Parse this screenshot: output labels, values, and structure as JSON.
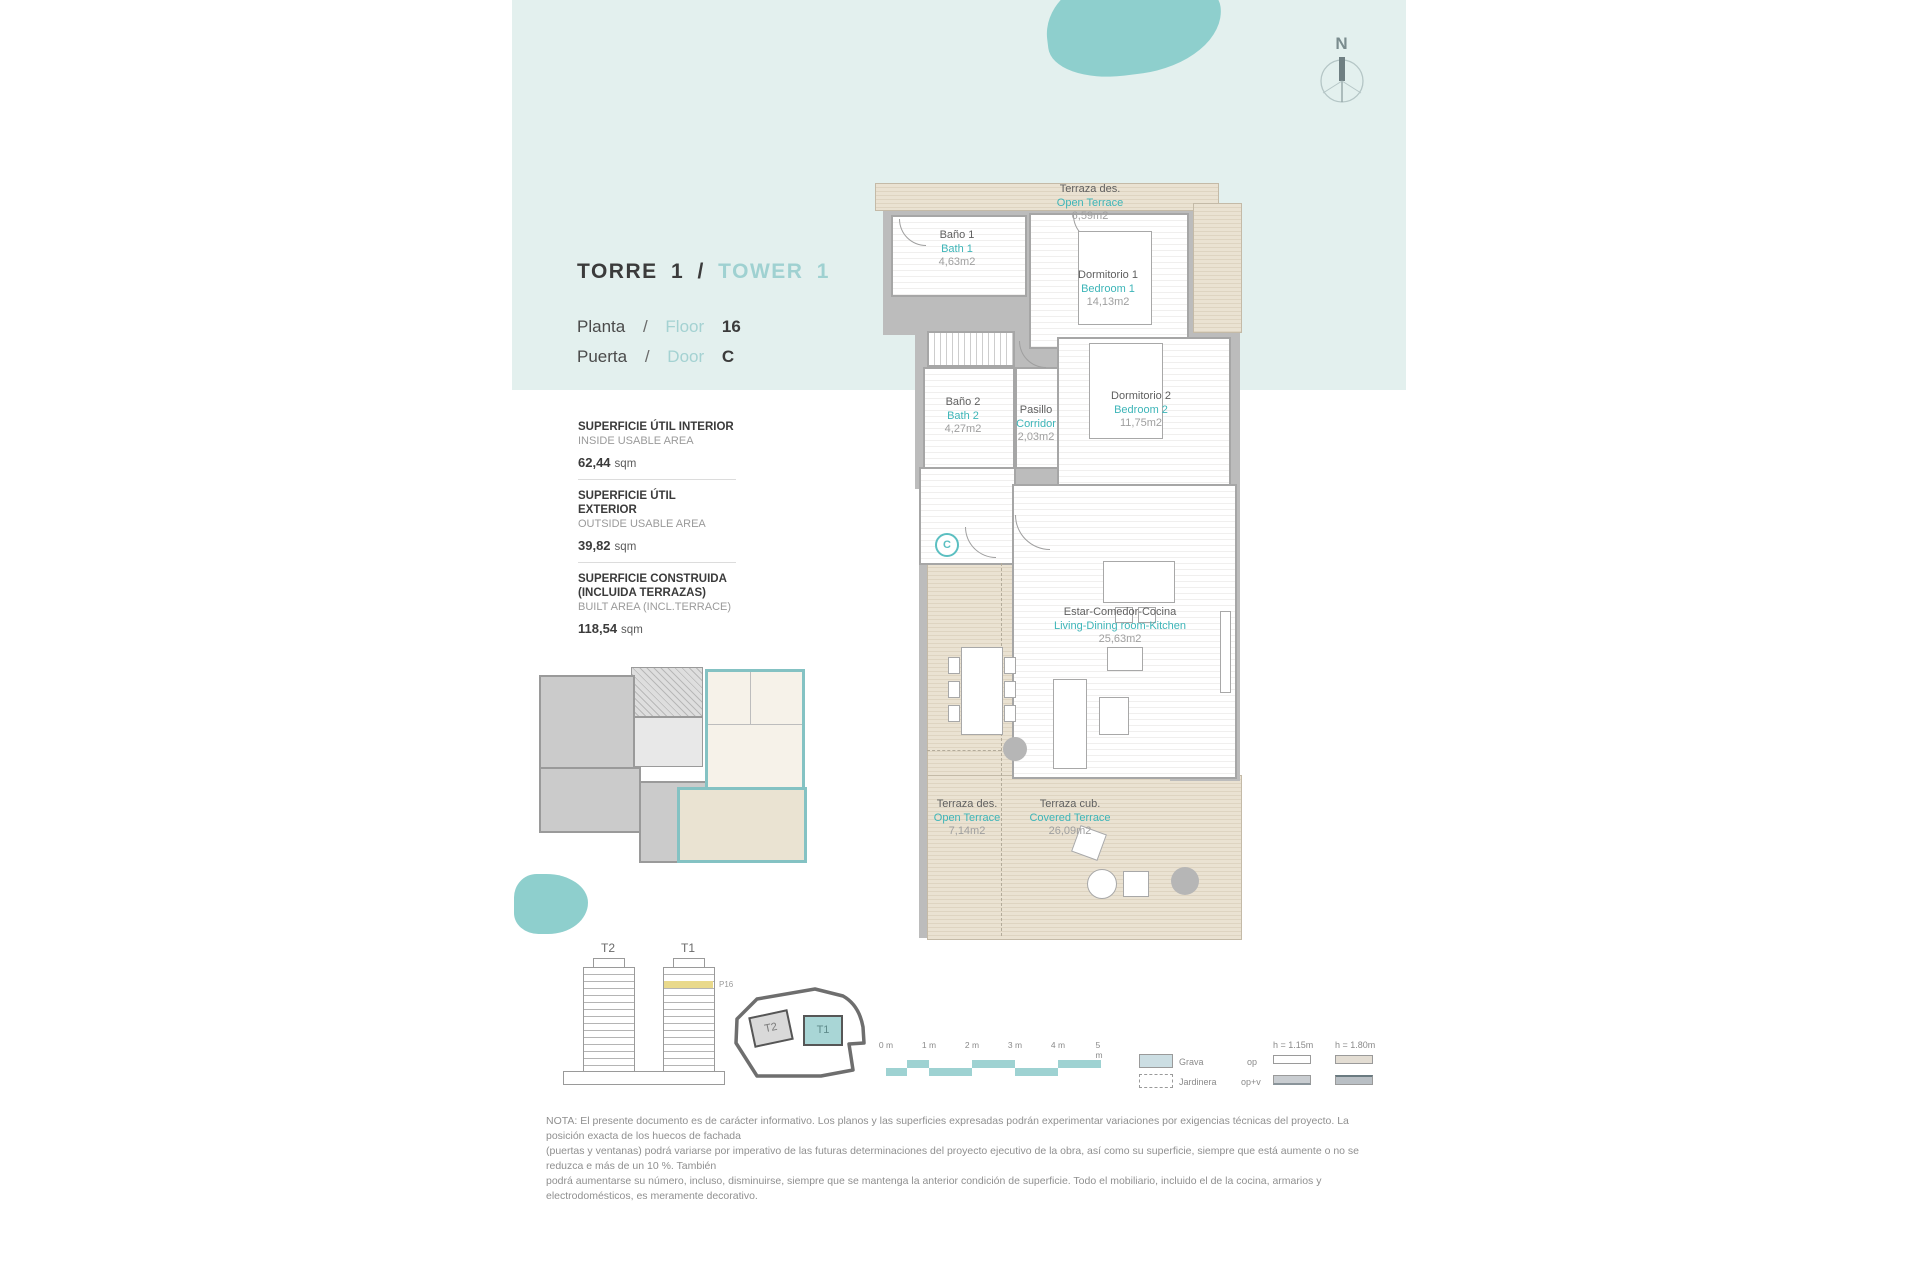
{
  "compass": {
    "label": "N"
  },
  "header": {
    "torre": "TORRE 1",
    "sep": "/",
    "tower": "TOWER 1",
    "planta": "Planta",
    "floor": "Floor",
    "floor_value": "16",
    "puerta": "Puerta",
    "door": "Door",
    "door_value": "C"
  },
  "areas": [
    {
      "title_es": "SUPERFICIE ÚTIL INTERIOR",
      "title_en": "INSIDE USABLE AREA",
      "value": "62,44",
      "unit": "sqm"
    },
    {
      "title_es": "SUPERFICIE ÚTIL EXTERIOR",
      "title_en": "OUTSIDE USABLE AREA",
      "value": "39,82",
      "unit": "sqm"
    },
    {
      "title_es": "SUPERFICIE CONSTRUIDA (INCLUIDA TERRAZAS)",
      "title_en": "BUILT AREA (INCL.TERRACE)",
      "value": "118,54",
      "unit": "sqm"
    }
  ],
  "rooms": {
    "terrace_top": {
      "es": "Terraza des.",
      "en": "Open Terrace",
      "area": "6,59m2"
    },
    "bath1": {
      "es": "Baño 1",
      "en": "Bath 1",
      "area": "4,63m2"
    },
    "bedroom1": {
      "es": "Dormitorio 1",
      "en": "Bedroom 1",
      "area": "14,13m2"
    },
    "bath2": {
      "es": "Baño 2",
      "en": "Bath 2",
      "area": "4,27m2"
    },
    "corridor": {
      "es": "Pasillo",
      "en": "Corridor",
      "area": "2,03m2"
    },
    "bedroom2": {
      "es": "Dormitorio 2",
      "en": "Bedroom 2",
      "area": "11,75m2"
    },
    "living": {
      "es": "Estar-Comedor-Cocina",
      "en": "Living-Dining room-Kitchen",
      "area": "25,63m2"
    },
    "terrace_open": {
      "es": "Terraza des.",
      "en": "Open Terrace",
      "area": "7,14m2"
    },
    "terrace_covered": {
      "es": "Terraza cub.",
      "en": "Covered Terrace",
      "area": "26,09m2"
    },
    "door_marker": "C"
  },
  "towers": {
    "t2": "T2",
    "t1": "T1",
    "floor_tag": "P16"
  },
  "siteplan": {
    "t2": "T2",
    "t1": "T1"
  },
  "scalebar": {
    "ticks": [
      "0 m",
      "1 m",
      "2 m",
      "3 m",
      "4 m",
      "5 m"
    ]
  },
  "legend": {
    "grava": "Grava",
    "jardinera": "Jardinera",
    "op": "op",
    "opv": "op+v",
    "h1": "h = 1.15m",
    "h2": "h = 1.80m"
  },
  "note": {
    "line1": "NOTA: El presente documento es de carácter informativo. Los planos y las superficies expresadas podrán experimentar variaciones por exigencias técnicas del proyecto. La posición exacta de los huecos de fachada",
    "line2": "(puertas y ventanas) podrá variarse por imperativo de las futuras determinaciones del proyecto ejecutivo de la obra, así como su superficie, siempre que está aumente o no se reduzca e más de un 10 %. También",
    "line3": "podrá aumentarse su número, incluso, disminuirse, siempre que se mantenga la anterior condición de superficie. Todo el mobiliario, incluido el de la cocina, armarios y electrodomésticos, es meramente decorativo."
  },
  "colors": {
    "accent_teal": "#3db5b8",
    "light_teal": "#a0d2d3",
    "band": "#e3f0ee",
    "blob": "#8ecfcd",
    "wood": "#e9e1d1",
    "wall": "#bcbcbc",
    "highlight_floor": "#e9d98c"
  }
}
